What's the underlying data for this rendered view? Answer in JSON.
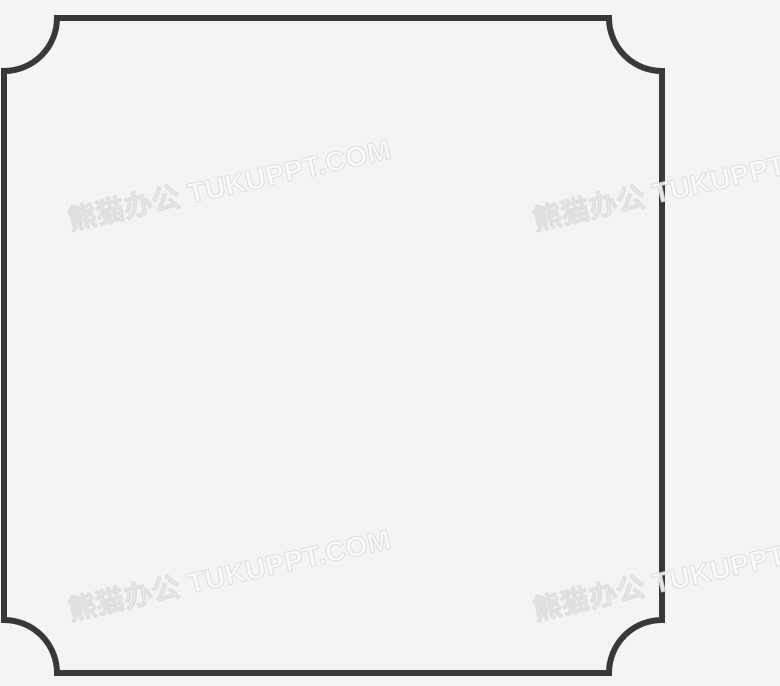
{
  "canvas": {
    "width": 780,
    "height": 686,
    "background_color": "#f4f4f5"
  },
  "frame": {
    "shape": "square-frame-with-concave-scooped-corners",
    "stroke_color": "#38383a",
    "stroke_width": "6",
    "fill": "none",
    "corner_radius": 53,
    "path": "M 57,18 H 609 A 53,53 0 0 0 662,71 V 620 A 53,53 0 0 0 609,673 H 57 A 53,53 0 0 0 4,620 V 71 A 53,53 0 0 0 57,18 Z"
  },
  "watermark": {
    "text": "熊猫办公 TUKUPPT.COM",
    "fill_color": "#ffffff",
    "outline_color": "#cdcdcf",
    "rotation_deg": -12.6,
    "instances": [
      {
        "position": "top-left"
      },
      {
        "position": "top-right"
      },
      {
        "position": "bottom-left"
      },
      {
        "position": "bottom-right"
      }
    ]
  }
}
